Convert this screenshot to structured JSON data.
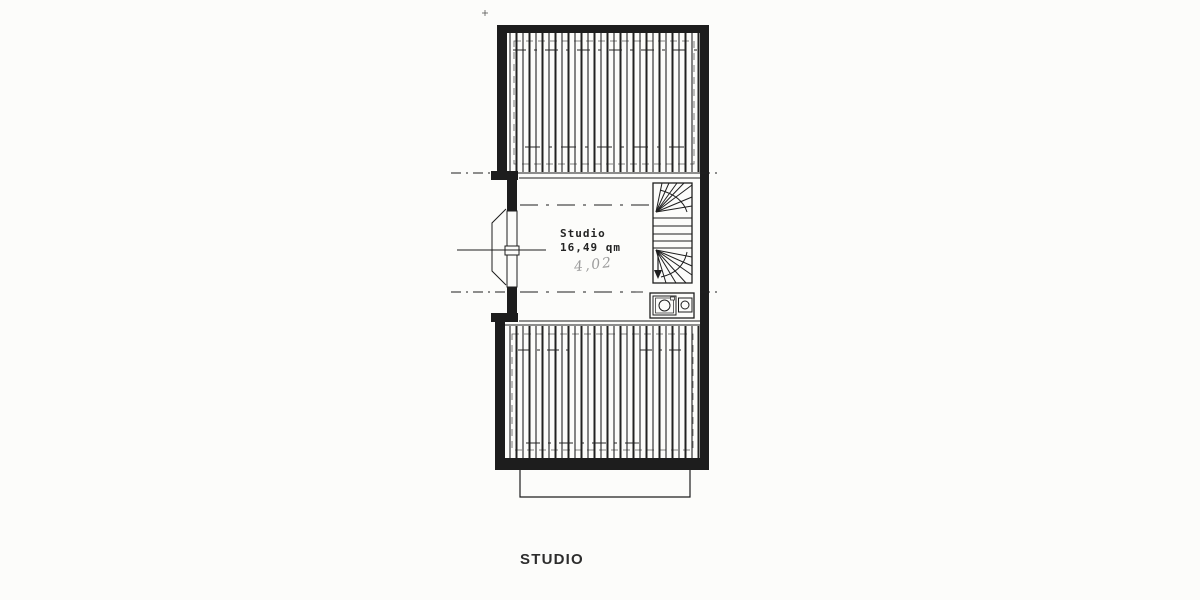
{
  "page": {
    "paper_color": "#fcfcfa",
    "ink_color": "#1e1e1e",
    "note_color": "#9c9c9c"
  },
  "plan": {
    "room_name": "Studio",
    "room_area": "16,49 qm",
    "handwritten_note": "4,02",
    "caption": "STUDIO"
  }
}
